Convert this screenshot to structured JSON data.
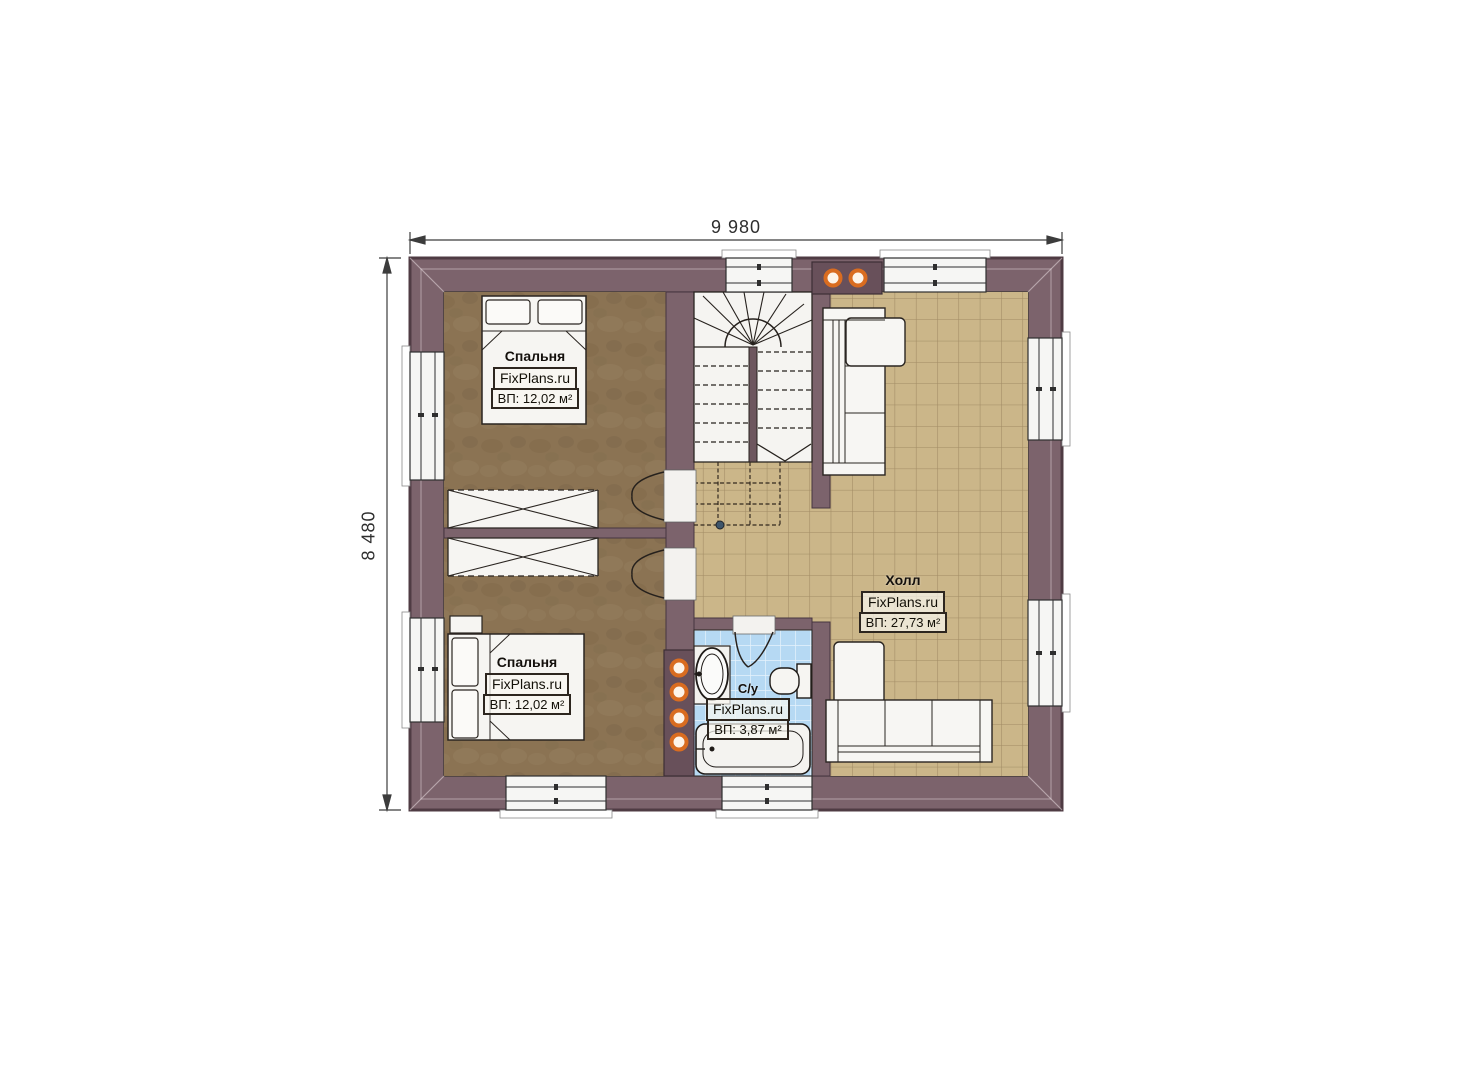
{
  "page": {
    "title": "Floor plan — second level"
  },
  "dimensions": {
    "top": "9 980",
    "left": "8 480"
  },
  "rooms": {
    "bedroom1": {
      "name": "Спальня",
      "watermark": "FixPlans.ru",
      "area_label": "ВП: 12,02 м²"
    },
    "bedroom2": {
      "name": "Спальня",
      "watermark": "FixPlans.ru",
      "area_label": "ВП: 12,02 м²"
    },
    "hall": {
      "name": "Холл",
      "watermark": "FixPlans.ru",
      "area_label": "ВП: 27,73 м²"
    },
    "bathroom": {
      "name": "С/у",
      "watermark": "FixPlans.ru",
      "area_label": "ВП: 3,87 м²"
    }
  },
  "colors": {
    "wall": "#7c636c",
    "wall_outline": "#4f3b43",
    "vent_block": "#68505a",
    "bedroom_floor": "#8b7353",
    "hall_floor": "#cbb689",
    "hall_grid": "#a18b64",
    "bath_floor": "#b6d9f3",
    "vent_ring": "#d96c20",
    "furniture": "#f6f5f2",
    "linework": "#26211d",
    "dimension_line": "#3c3c3c"
  }
}
